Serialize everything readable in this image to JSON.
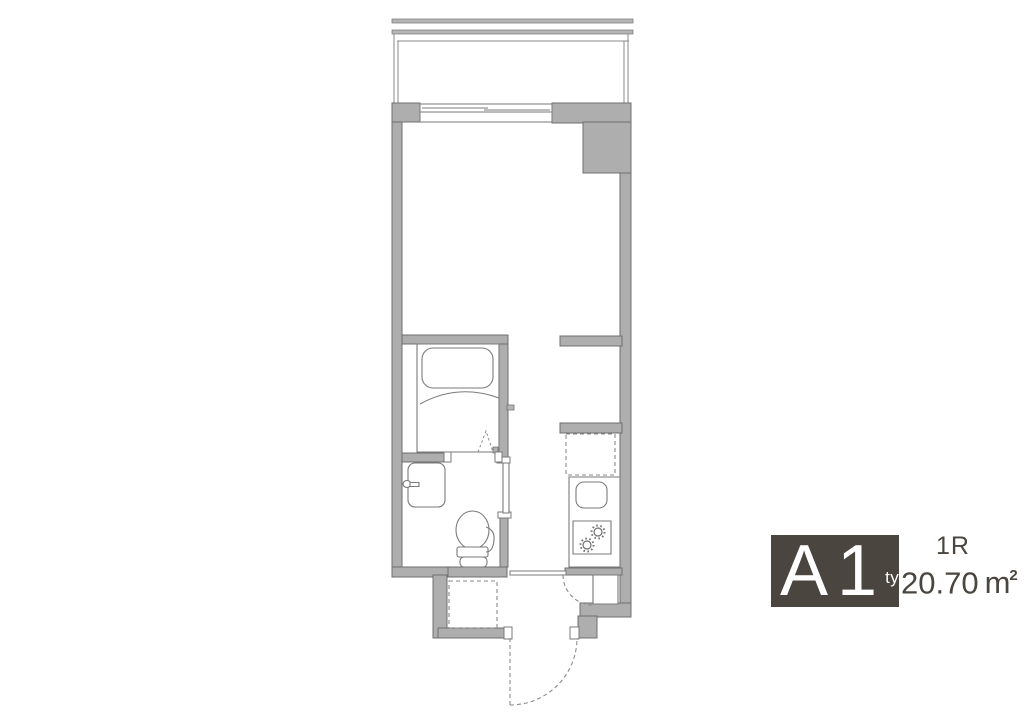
{
  "legend": {
    "plan_letter": "A",
    "plan_number": "1",
    "type_label": "type",
    "layout": "1R",
    "area_value": "20.70",
    "area_unit_base": "m",
    "area_unit_sup": "2",
    "box_color": "#4a453e",
    "text_color": "#4a453e"
  },
  "palette": {
    "wall_fill": "#aeaeae",
    "wall_stroke": "#6f6f6f",
    "line": "#8a8a8a",
    "fixture_stroke": "#7a7a7a"
  },
  "fixtures": [
    "balcony-railing",
    "sliding-window",
    "bathtub",
    "bathroom-folding-door",
    "washbasin",
    "toilet",
    "washroom-sliding-door",
    "refrigerator-space",
    "kitchen-counter",
    "kitchen-sink",
    "gas-stove",
    "washing-machine-space",
    "shoe-cabinet",
    "hall-door",
    "entrance-door"
  ]
}
